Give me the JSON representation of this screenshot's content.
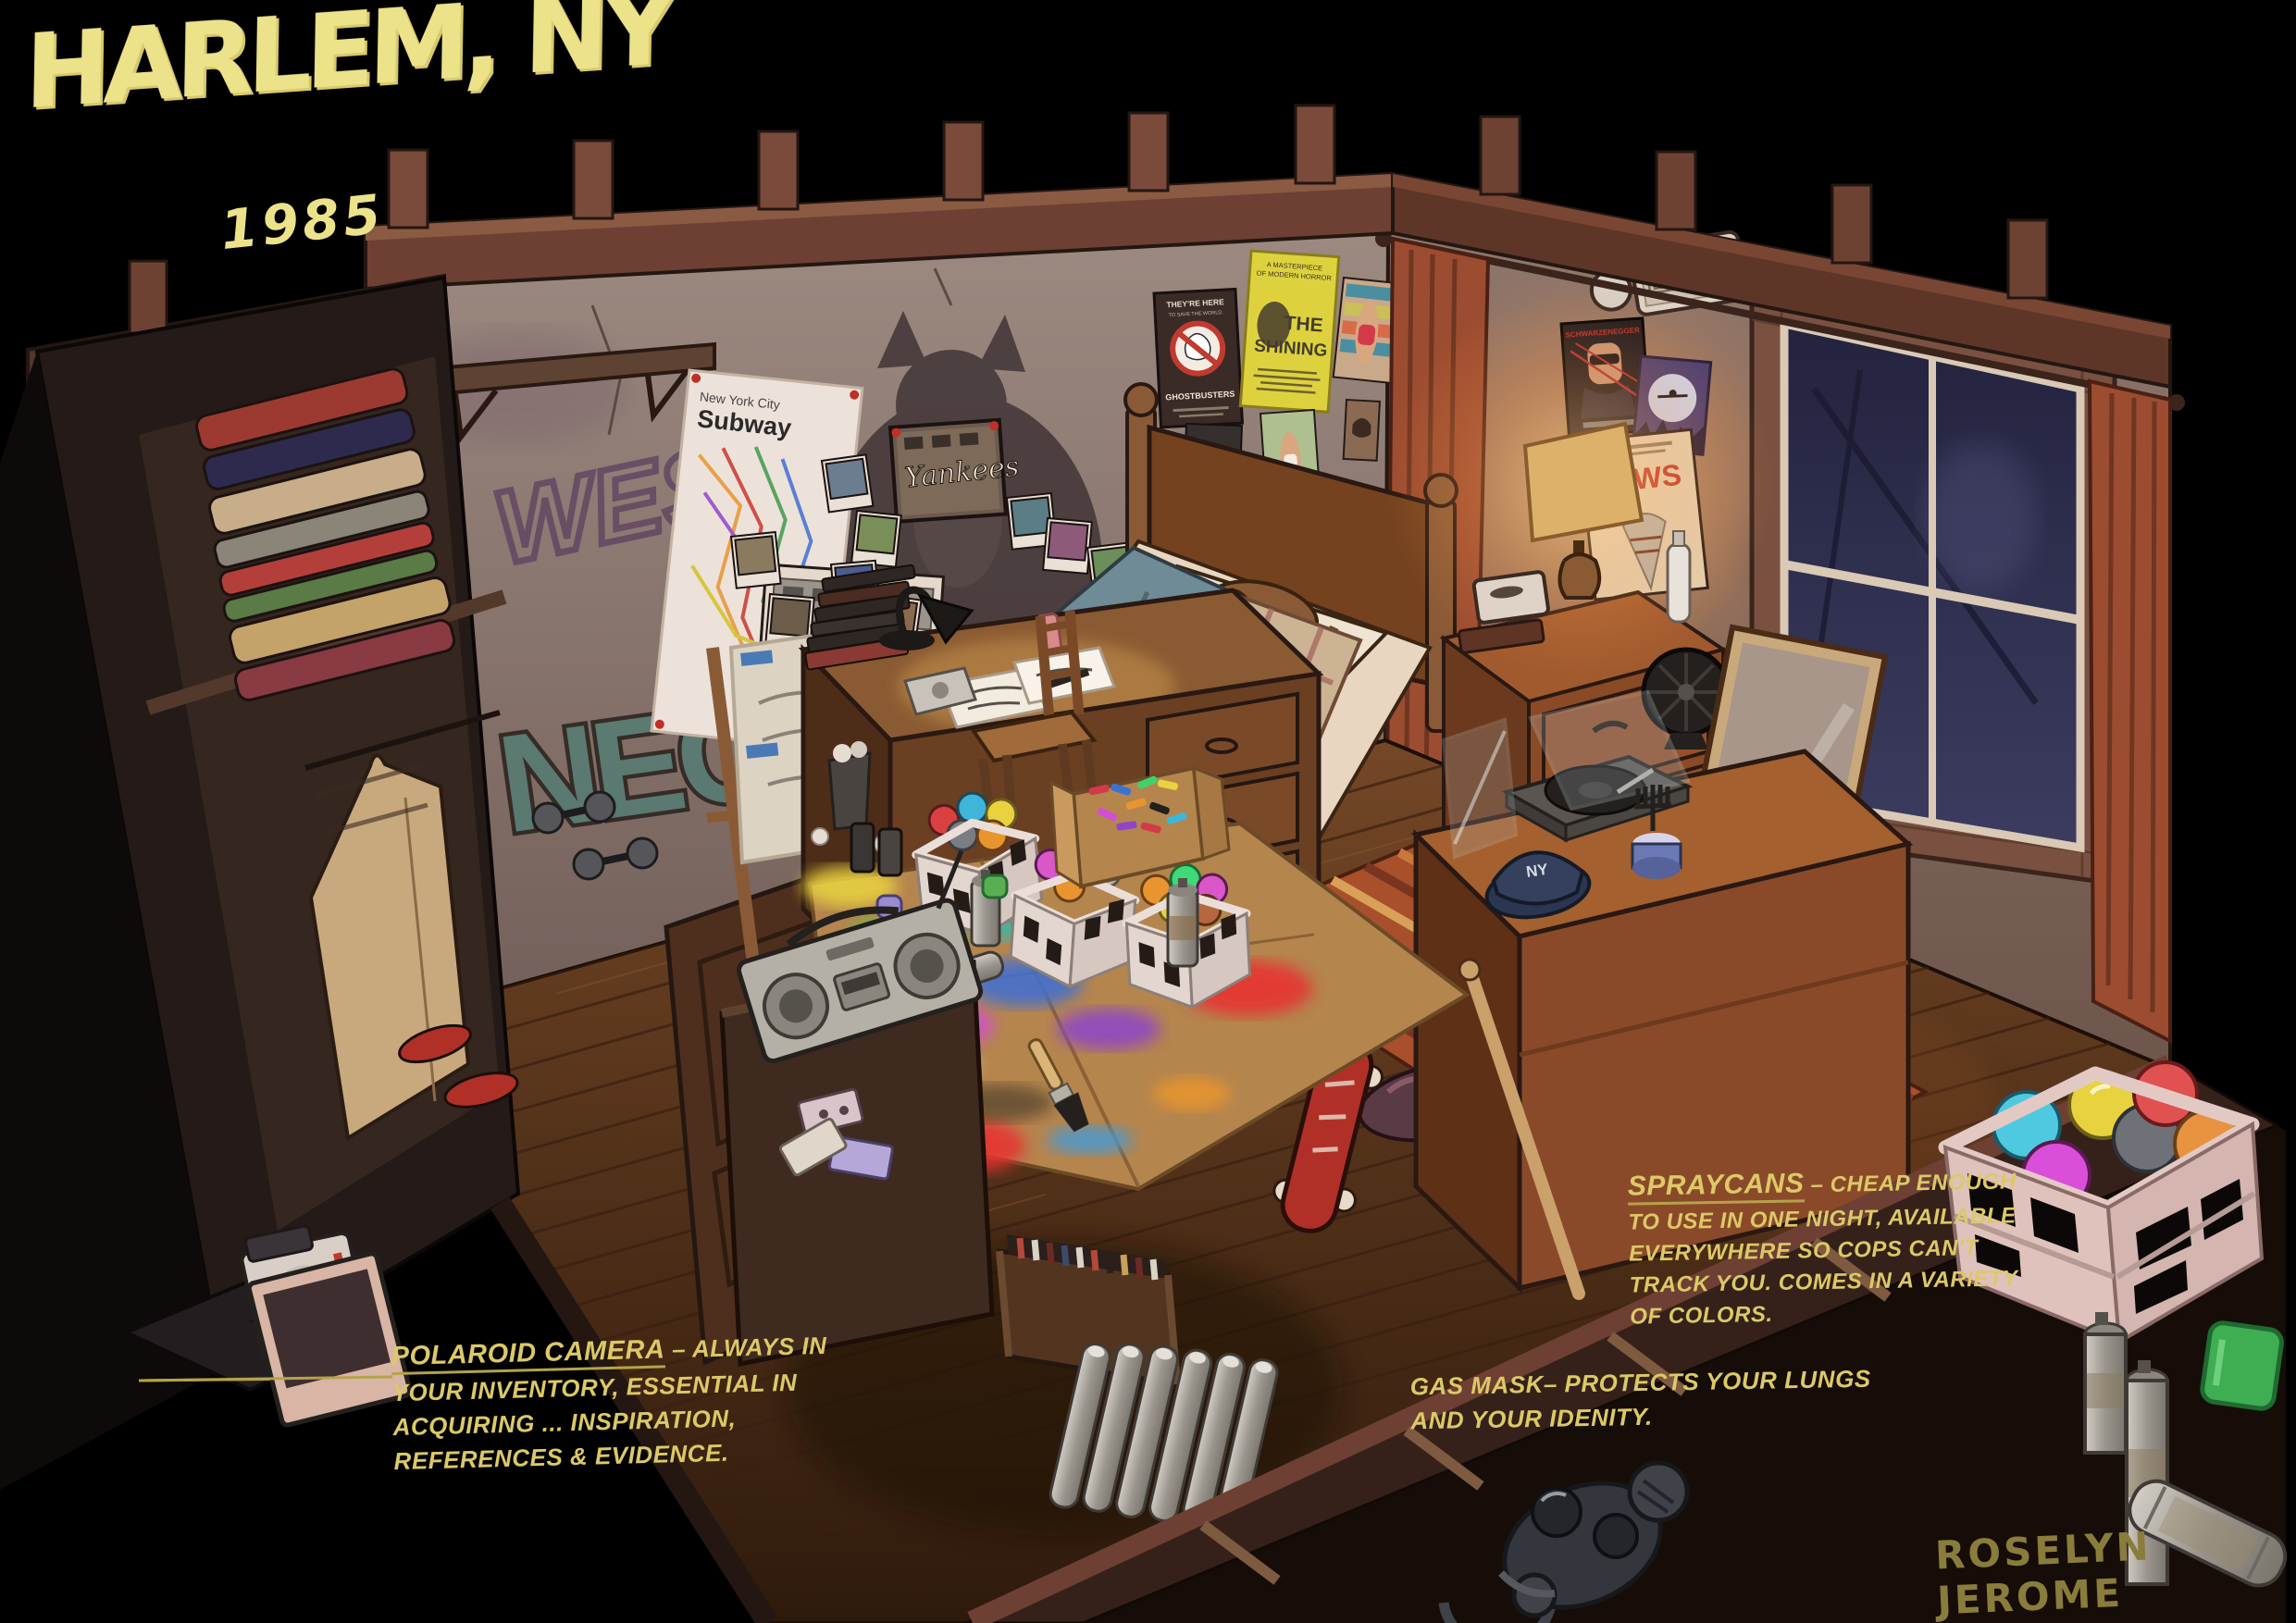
{
  "title": {
    "city": "HARLEM, NY",
    "year": "1985"
  },
  "signature": "ROSELYN JEROME",
  "notes": {
    "polaroid": {
      "term": "POLAROID CAMERA",
      "line1_rest": "– ALWAYS IN",
      "line2": "YOUR INVENTORY, ESSENTIAL IN",
      "line3": "ACQUIRING ... INSPIRATION,",
      "line4": "REFERENCES & EVIDENCE."
    },
    "gas_mask": {
      "line1": "GAS MASK– PROTECTS YOUR LUNGS",
      "line2": "AND YOUR IDENITY."
    },
    "spraycans": {
      "term": "SPRAYCANS",
      "line1_rest": "–  CHEAP ENOUGH",
      "line2": "TO USE IN ONE NIGHT, AVAILABLE",
      "line3": "EVERYWHERE SO COPS CAN'T",
      "line4": "TRACK YOU.  COMES IN A VARIETY",
      "line5": "OF COLORS."
    }
  },
  "scene": {
    "exit_sign": "EXIT",
    "subway_map": {
      "line1": "New York City",
      "line2": "Subway"
    },
    "posters": {
      "ghostbusters_tagline": "THEY'RE HERE",
      "ghostbusters_subline": "TO SAVE THE WORLD.",
      "ghostbusters_title": "GHOSTBUSTERS",
      "shining_tagline_1": "A MASTERPIECE",
      "shining_tagline_2": "OF MODERN HORROR",
      "shining_title_1": "THE",
      "shining_title_2": "SHINING",
      "terminator_top": "SCHWARZENEGGER",
      "et_title": "E.T.",
      "jaws_title": "JAWS",
      "playboy_title": "PLAYBOY"
    },
    "graffiti": {
      "wall_tag": "WES",
      "wall_throwup": "NEON",
      "wall_chain": "S"
    },
    "photos": {
      "yankees_graffiti": "Yankees",
      "seen_graffiti": "SEEN"
    },
    "cap_logo": "NY",
    "objects": [
      "bed with plaid blanket",
      "sleeping cat on pillow",
      "wooden headboard",
      "nightstand",
      "table lamp",
      "vanity mirror",
      "dresser",
      "record player",
      "yankees cap",
      "baseball bat",
      "skateboard",
      "striped rug",
      "clothes pile",
      "desk",
      "desk lamp",
      "wooden chair",
      "sketchbook stack",
      "easel with canvas",
      "trash bin",
      "milk crates of spray cans",
      "loose spray cans",
      "cardboard drop sheet with paint tests",
      "paint brush",
      "box of markers",
      "boombox",
      "cassette tapes",
      "crate of records",
      "radiator",
      "closet with folded clothes",
      "hanging shirt",
      "sneakers",
      "dumbbells",
      "door",
      "wall shelf",
      "subway map poster",
      "pinned polaroid photos",
      "cat mural",
      "graffiti tags",
      "movie posters",
      "exit sign",
      "window with curtains",
      "electric fan",
      "glass display case",
      "polaroid camera (legend)",
      "instant photo (legend)",
      "gas mask (legend)",
      "milk crate of spray cans (legend)",
      "green cap (legend)"
    ]
  },
  "colors": {
    "background": "#000000",
    "title_yellow": "#ece28a",
    "note_yellow": "#dcc967",
    "signature_olive": "#8a7c3b",
    "wall_warm_gray": "#8d776e",
    "wood_brown": "#6b4027",
    "floor_dark": "#46280f",
    "curtain_rust": "#9c4c30",
    "blanket_teal": "#6e8b96",
    "crate_white": "#e8dcd6",
    "crate_pink": "#dfc2bc"
  }
}
